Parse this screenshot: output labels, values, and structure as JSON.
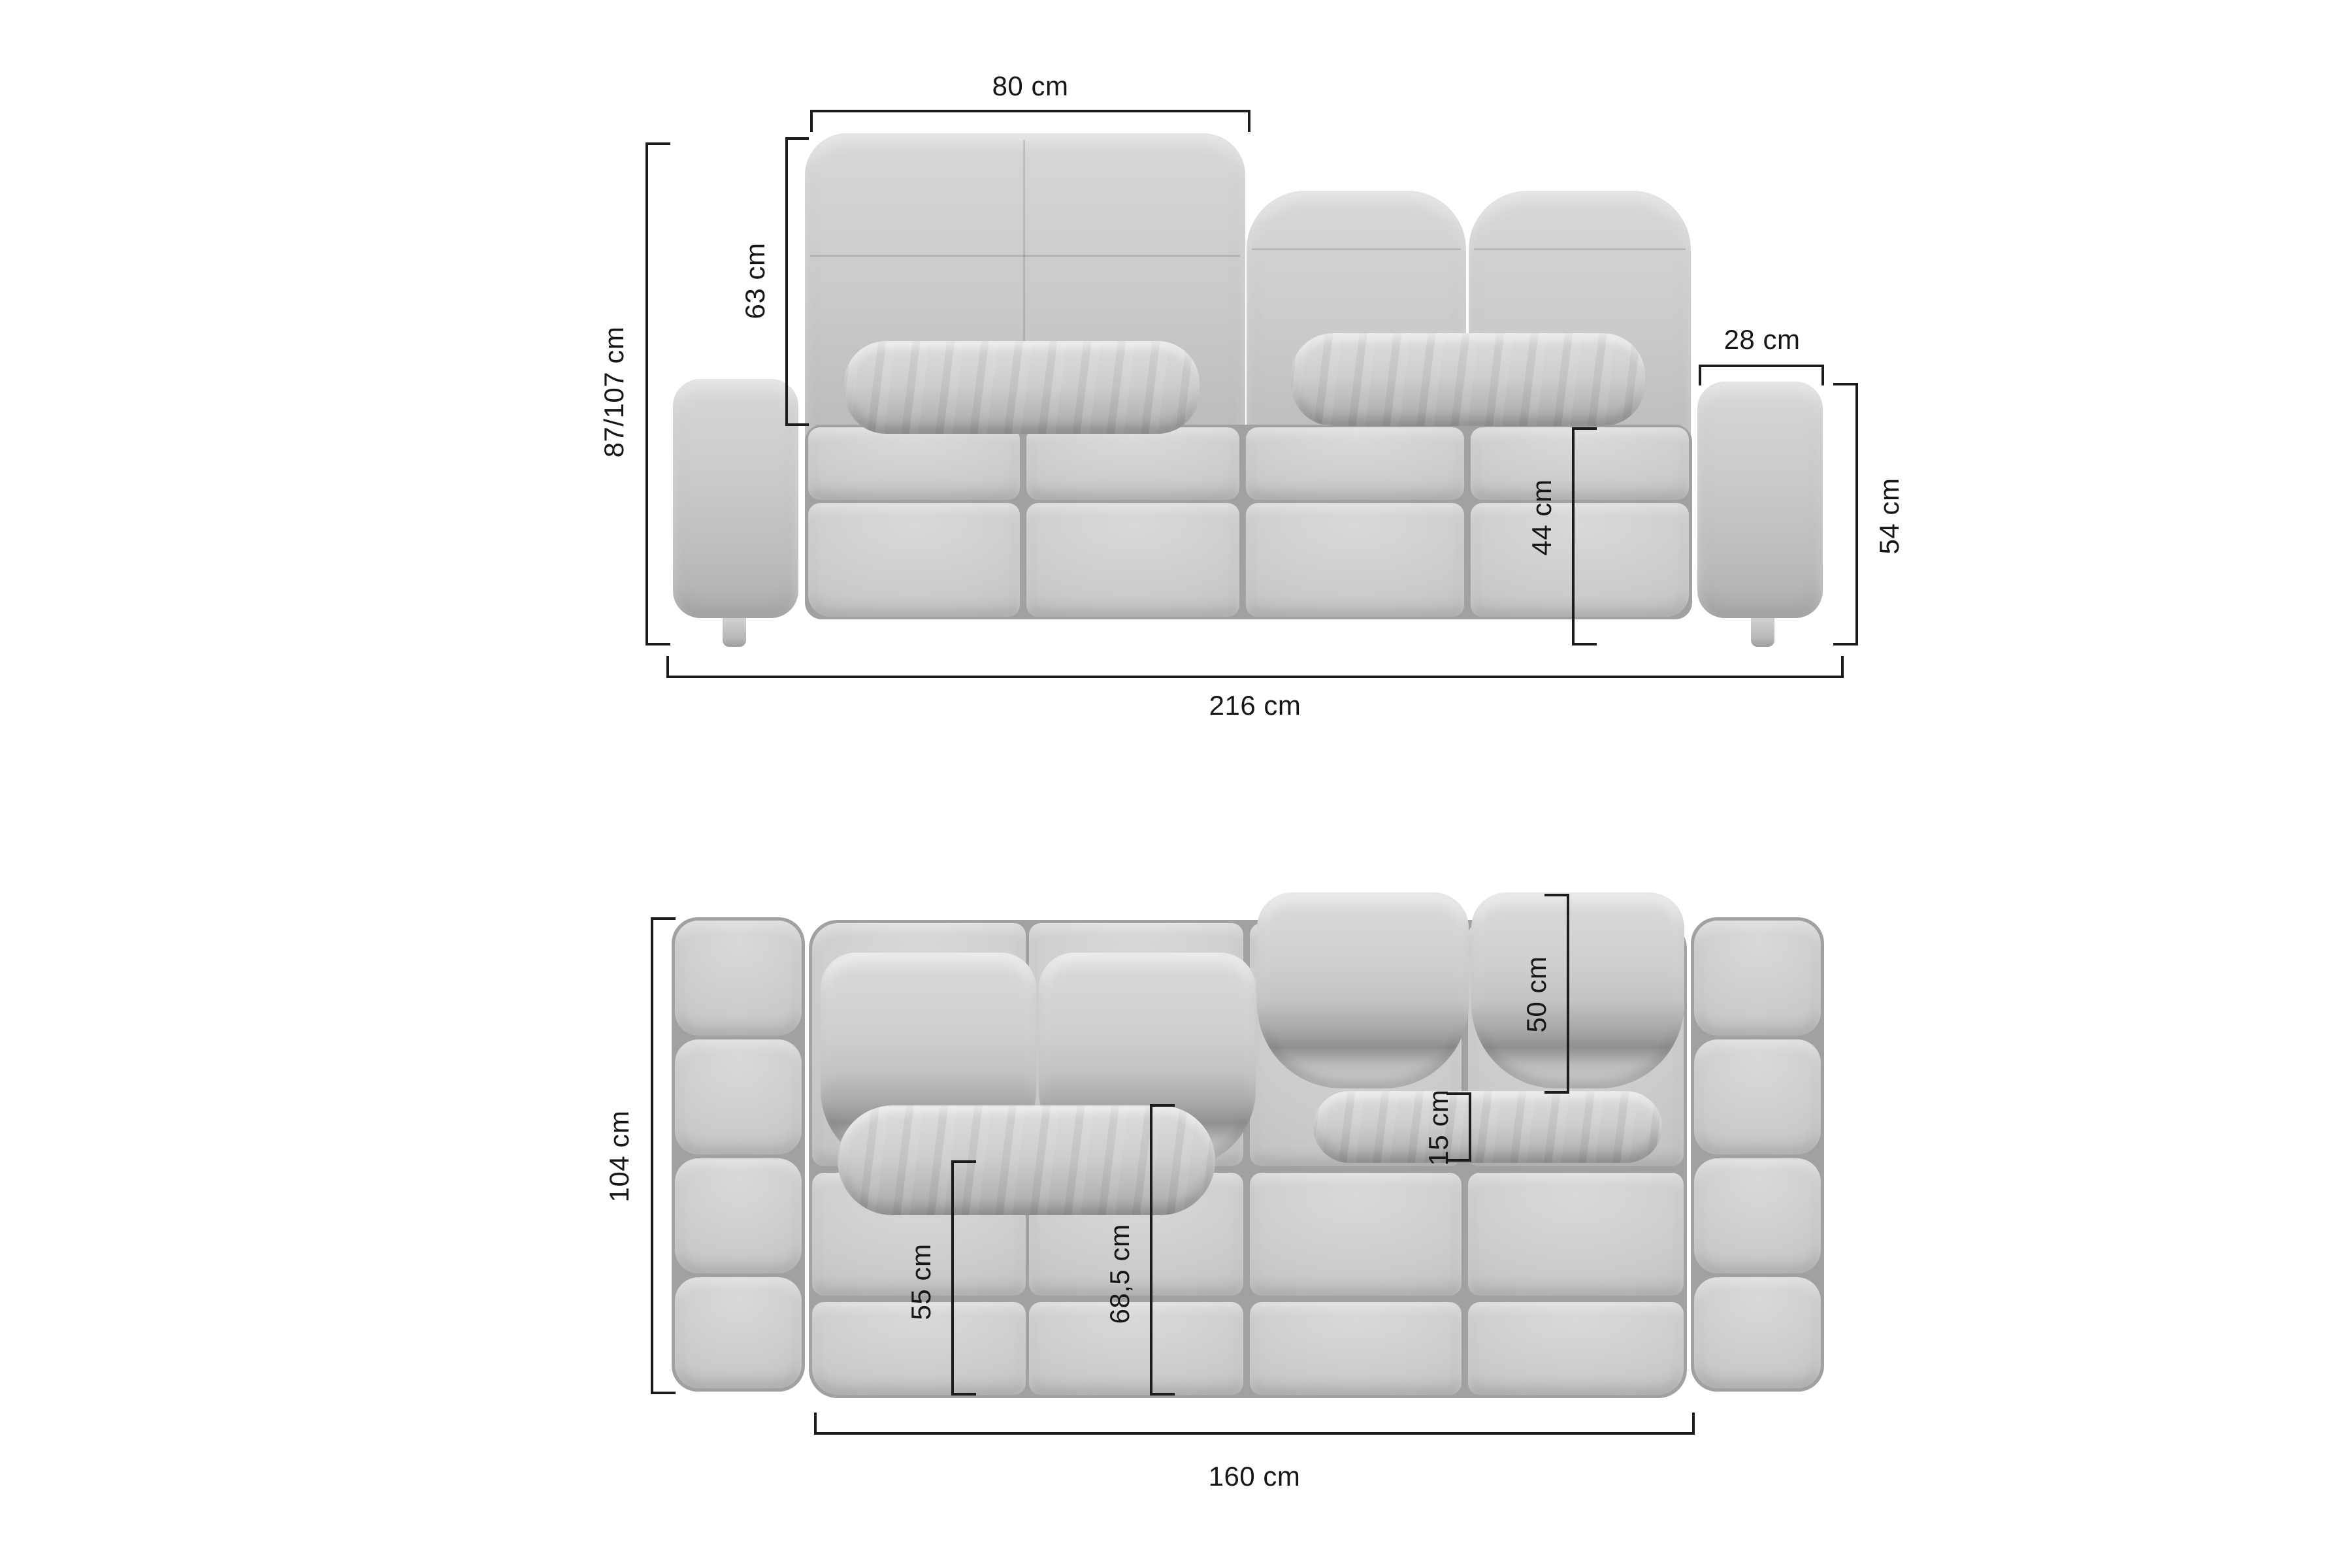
{
  "diagram": {
    "subject": "sofa-dimension-diagram",
    "views": {
      "front": {
        "dims": {
          "backrest_width": "80 cm",
          "backrest_height": "63 cm",
          "overall_height": "87/107 cm",
          "armrest_width": "28 cm",
          "seat_height": "44 cm",
          "armrest_height": "54 cm",
          "overall_width": "216 cm"
        }
      },
      "top": {
        "dims": {
          "overall_depth": "104 cm",
          "back_cushion_depth": "50 cm",
          "lumbar_pillow_depth": "15 cm",
          "seat_depth": "55 cm",
          "seat_depth_with_pillow": "68,5 cm",
          "seat_width": "160 cm"
        }
      }
    },
    "colors": {
      "background": "#ffffff",
      "upholstery": "#c6c7c9",
      "upholstery_shadow": "#a0a1a3",
      "dimension_line": "#1c1c1c",
      "dimension_text": "#161616"
    }
  }
}
